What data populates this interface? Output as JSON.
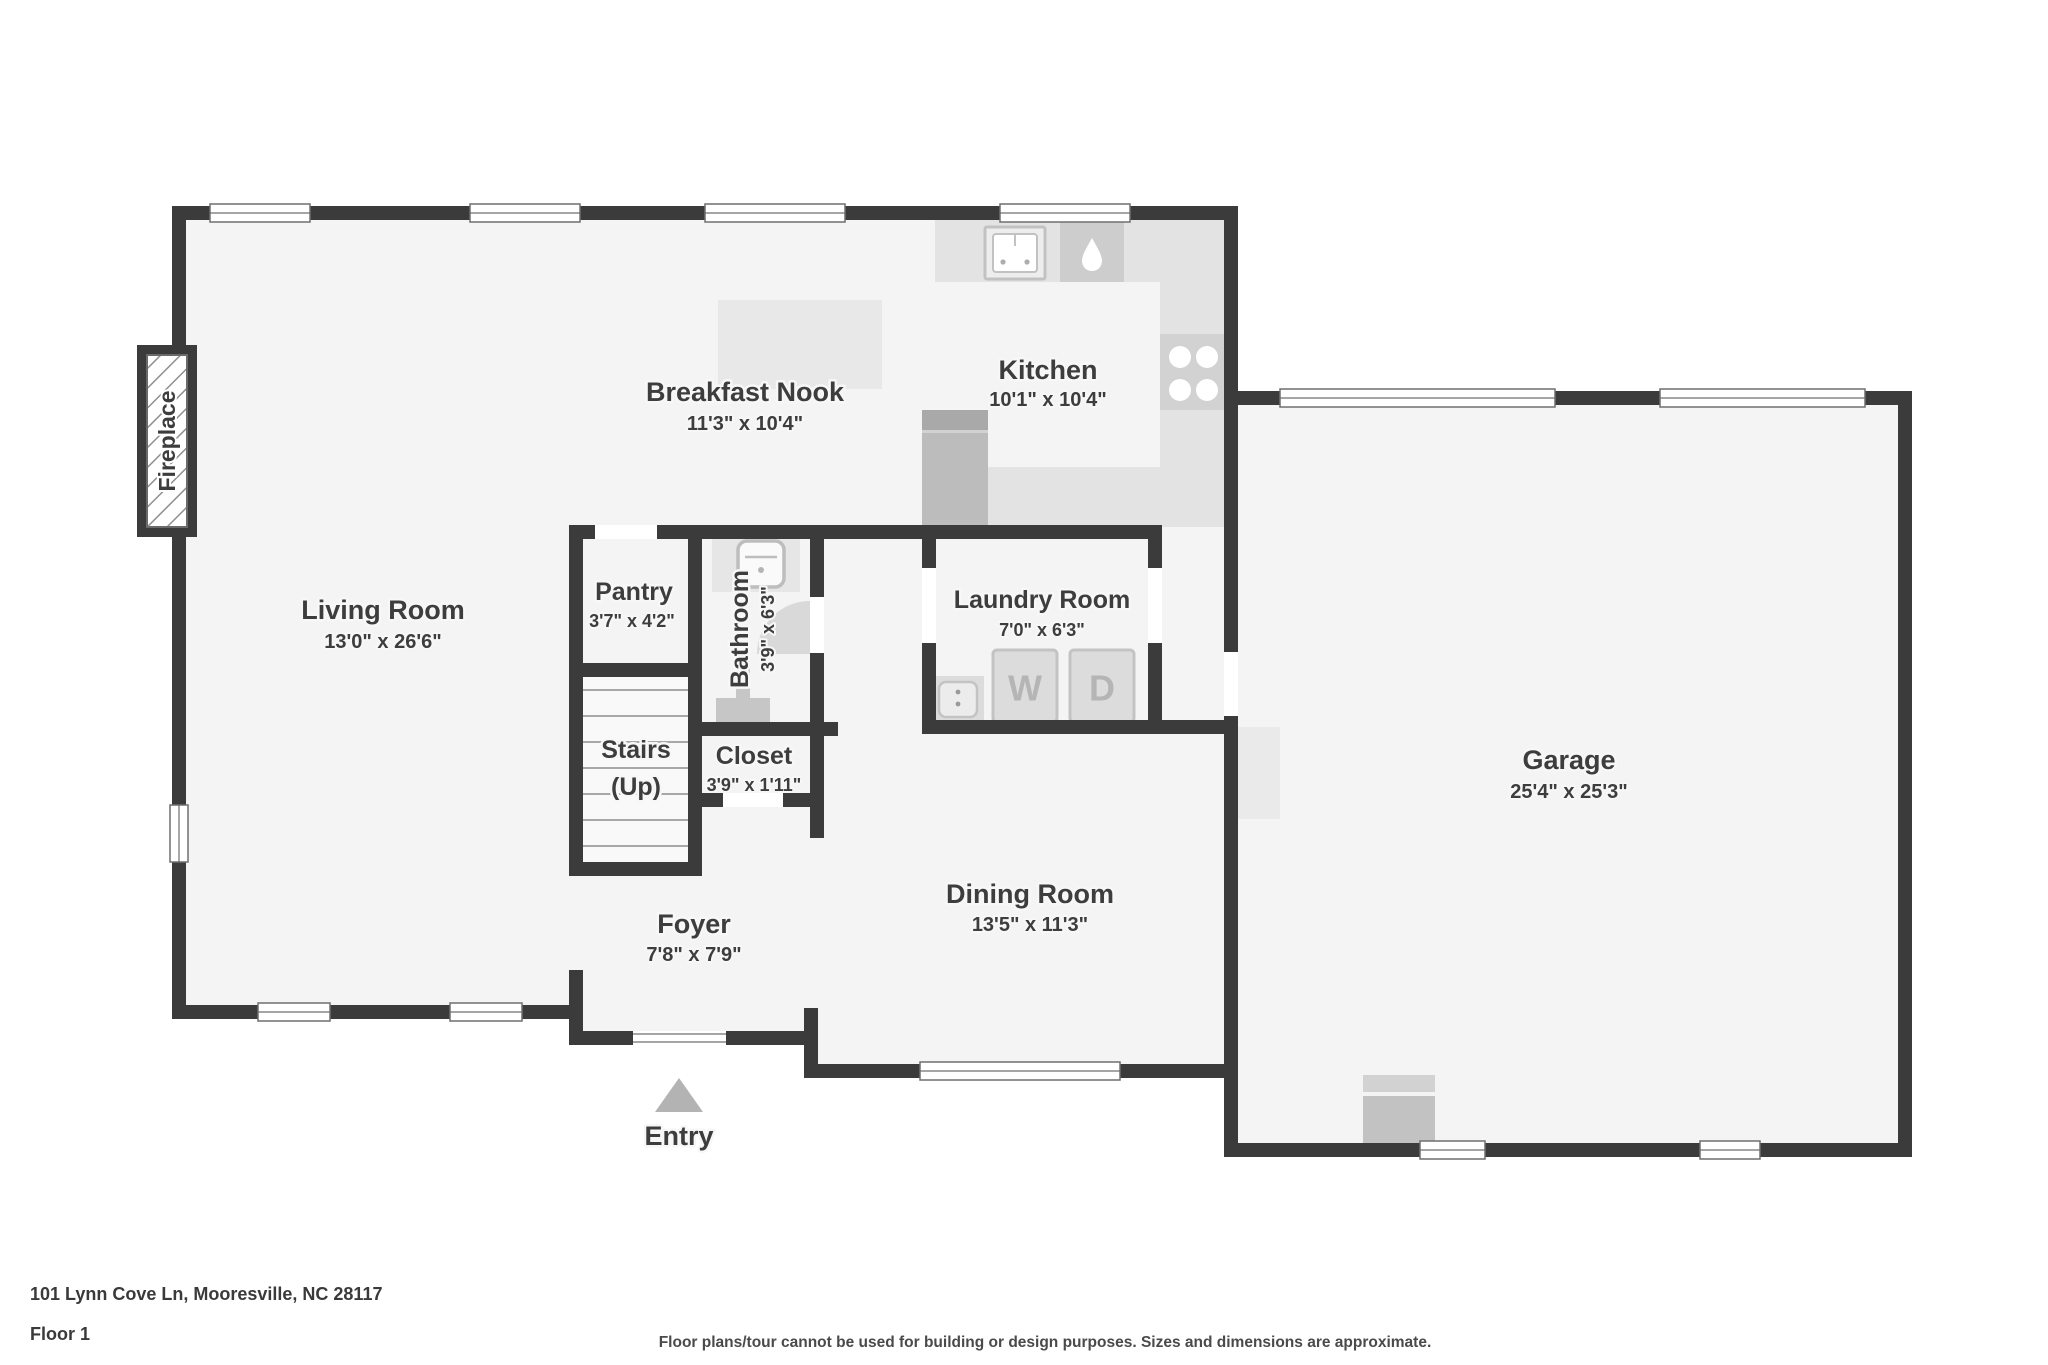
{
  "rooms": {
    "living_room": {
      "name": "Living Room",
      "dims": "13'0\" x 26'6\""
    },
    "breakfast_nook": {
      "name": "Breakfast Nook",
      "dims": "11'3\" x 10'4\""
    },
    "kitchen": {
      "name": "Kitchen",
      "dims": "10'1\" x 10'4\""
    },
    "pantry": {
      "name": "Pantry",
      "dims": "3'7\" x 4'2\""
    },
    "bathroom": {
      "name": "Bathroom",
      "dims": "3'9\" x 6'3\""
    },
    "stairs": {
      "line1": "Stairs",
      "line2": "(Up)"
    },
    "closet": {
      "name": "Closet",
      "dims": "3'9\" x 1'11\""
    },
    "laundry_room": {
      "name": "Laundry Room",
      "dims": "7'0\" x 6'3\""
    },
    "dining_room": {
      "name": "Dining Room",
      "dims": "13'5\" x 11'3\""
    },
    "foyer": {
      "name": "Foyer",
      "dims": "7'8\" x 7'9\""
    },
    "garage": {
      "name": "Garage",
      "dims": "25'4\" x 25'3\""
    }
  },
  "annotations": {
    "fireplace": "Fireplace",
    "entry": "Entry",
    "washer": "W",
    "dryer": "D"
  },
  "footer": {
    "address": "101 Lynn Cove Ln, Mooresville, NC 28117",
    "floor": "Floor 1",
    "disclaimer": "Floor plans/tour cannot be used for building or design purposes. Sizes and dimensions are approximate."
  },
  "colors": {
    "wall": "#3b3b3b",
    "floor": "#f4f4f4",
    "label_text": "#3d3d3d"
  }
}
